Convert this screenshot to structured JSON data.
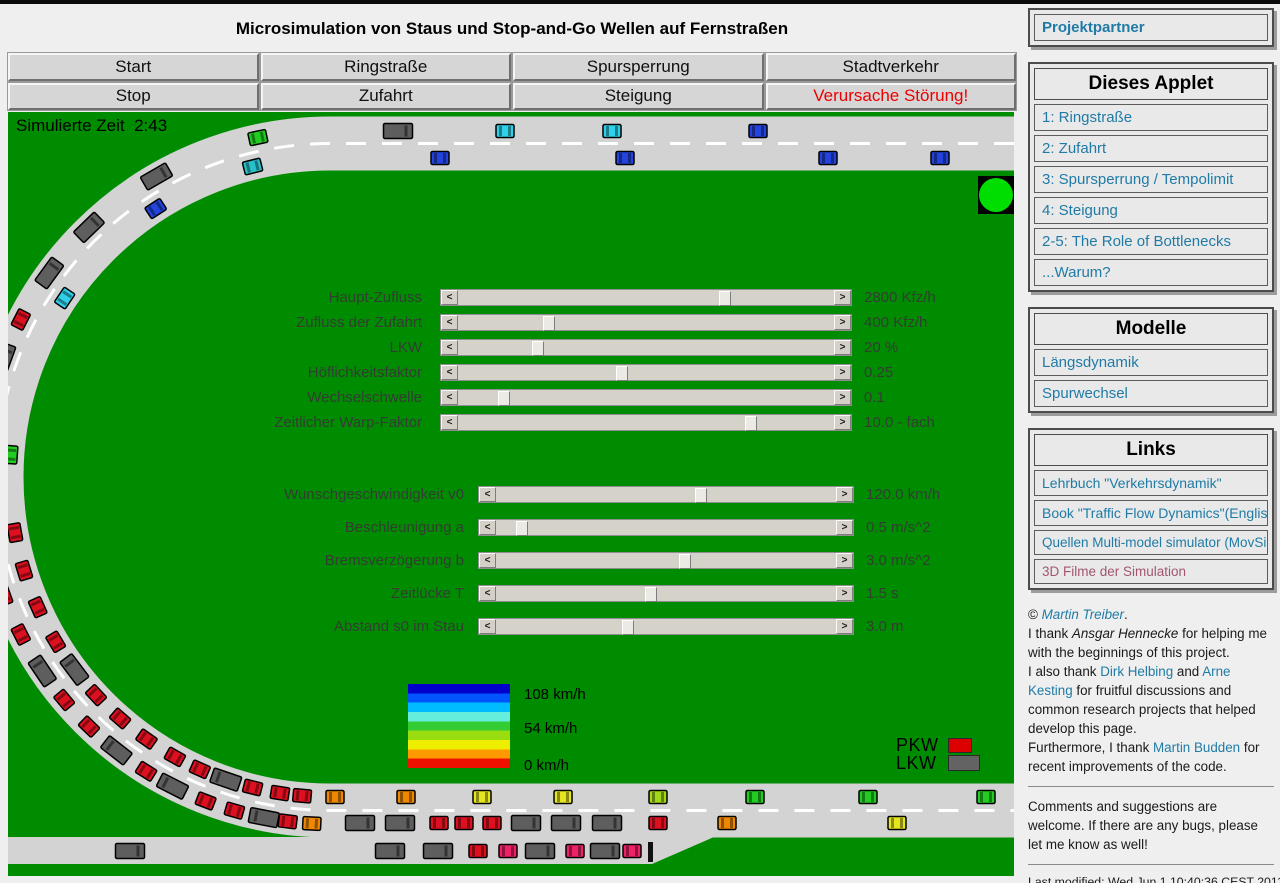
{
  "header": {
    "title": "Microsimulation von Staus und Stop-and-Go Wellen auf Fernstraßen",
    "buttons": [
      {
        "label": "Start"
      },
      {
        "label": "Ringstraße"
      },
      {
        "label": "Spursperrung"
      },
      {
        "label": "Stadtverkehr"
      },
      {
        "label": "Stop"
      },
      {
        "label": "Zufahrt"
      },
      {
        "label": "Steigung"
      },
      {
        "label": "Verursache Störung!",
        "text_color": "#ee0000"
      }
    ]
  },
  "sim": {
    "time_label": "Simulierte Zeit  2:43",
    "background_color": "#008c00",
    "road_color": "#d3d3d3",
    "lane_marking_color": "#ffffff",
    "traffic_light_color": "#00dd00",
    "sliders_group1": [
      {
        "label": "Haupt-Zufluss",
        "value": "2800 Kfz/h",
        "frac": 0.71
      },
      {
        "label": "Zufluss der Zufahrt",
        "value": "400 Kfz/h",
        "frac": 0.23
      },
      {
        "label": "LKW",
        "value": "20 %",
        "frac": 0.2
      },
      {
        "label": "Höflichkeitsfaktor",
        "value": "0.25",
        "frac": 0.43
      },
      {
        "label": "Wechselschwelle",
        "value": "0.1",
        "frac": 0.11
      },
      {
        "label": "Zeitlicher Warp-Faktor",
        "value": "10.0 - fach",
        "frac": 0.78
      }
    ],
    "sliders_group2": [
      {
        "label": "Wunschgeschwindigkeit v0",
        "value": "120.0 km/h",
        "frac": 0.6
      },
      {
        "label": "Beschleunigung a",
        "value": "0.5 m/s^2",
        "frac": 0.06
      },
      {
        "label": "Bremsverzögerung b",
        "value": "3.0 m/s^2",
        "frac": 0.55
      },
      {
        "label": "Zeitlücke T",
        "value": "1.5 s",
        "frac": 0.45
      },
      {
        "label": "Abstand s0 im Stau",
        "value": "3.0 m",
        "frac": 0.38
      }
    ],
    "speed_legend": {
      "labels": [
        "108 km/h",
        "54 km/h",
        "0 km/h"
      ],
      "colors": [
        "#0000cc",
        "#0055ff",
        "#00bbff",
        "#66eedd",
        "#33cc33",
        "#99dd11",
        "#eeee00",
        "#ff9900",
        "#ee1100"
      ]
    },
    "vehicle_legend": [
      {
        "label": "PKW",
        "color": "#dd0000",
        "w": 22,
        "h": 13
      },
      {
        "label": "LKW",
        "color": "#636363",
        "w": 30,
        "h": 14
      }
    ],
    "vehicle_palette": {
      "green": "#22cc22",
      "teal": "#28c0c8",
      "cyan": "#30d0e8",
      "blue": "#2244dd",
      "red": "#dd1020",
      "pink": "#ee2266",
      "orange": "#ee8800",
      "yellow": "#e6e620",
      "ygreen": "#a0d818",
      "truck": "#5e5e5e"
    },
    "vehicles": {
      "top_upper": [
        {
          "x": 390,
          "c": "truck"
        },
        {
          "x": 497,
          "c": "cyan"
        },
        {
          "x": 604,
          "c": "cyan"
        },
        {
          "x": 750,
          "c": "blue"
        }
      ],
      "top_lower": [
        {
          "x": 432,
          "c": "blue"
        },
        {
          "x": 617,
          "c": "blue"
        },
        {
          "x": 820,
          "c": "blue"
        },
        {
          "x": 932,
          "c": "blue"
        }
      ],
      "bottom_upper": [
        {
          "x": 327,
          "c": "orange"
        },
        {
          "x": 398,
          "c": "orange"
        },
        {
          "x": 474,
          "c": "yellow"
        },
        {
          "x": 555,
          "c": "yellow"
        },
        {
          "x": 650,
          "c": "ygreen"
        },
        {
          "x": 747,
          "c": "green"
        },
        {
          "x": 860,
          "c": "green"
        },
        {
          "x": 978,
          "c": "green"
        }
      ],
      "bottom_lower": [
        {
          "x": 352,
          "c": "truck"
        },
        {
          "x": 392,
          "c": "truck"
        },
        {
          "x": 431,
          "c": "red"
        },
        {
          "x": 456,
          "c": "red"
        },
        {
          "x": 484,
          "c": "red"
        },
        {
          "x": 518,
          "c": "truck"
        },
        {
          "x": 558,
          "c": "truck"
        },
        {
          "x": 599,
          "c": "truck"
        },
        {
          "x": 650,
          "c": "red"
        },
        {
          "x": 719,
          "c": "orange"
        },
        {
          "x": 889,
          "c": "yellow"
        }
      ],
      "ramp": [
        {
          "x": 122,
          "c": "truck"
        },
        {
          "x": 382,
          "c": "truck"
        },
        {
          "x": 430,
          "c": "truck"
        },
        {
          "x": 470,
          "c": "red"
        },
        {
          "x": 500,
          "c": "pink"
        },
        {
          "x": 532,
          "c": "truck"
        },
        {
          "x": 567,
          "c": "pink"
        },
        {
          "x": 597,
          "c": "truck"
        },
        {
          "x": 624,
          "c": "pink"
        }
      ],
      "curve": [
        {
          "deg": 12,
          "lane": "O",
          "c": "green"
        },
        {
          "deg": 14,
          "lane": "I",
          "c": "teal"
        },
        {
          "deg": 30,
          "lane": "O",
          "c": "truck"
        },
        {
          "deg": 33,
          "lane": "I",
          "c": "blue"
        },
        {
          "deg": 44,
          "lane": "O",
          "c": "truck"
        },
        {
          "deg": 54,
          "lane": "O",
          "c": "truck"
        },
        {
          "deg": 56,
          "lane": "I",
          "c": "cyan"
        },
        {
          "deg": 63,
          "lane": "O",
          "c": "red"
        },
        {
          "deg": 70,
          "lane": "O",
          "c": "truck"
        },
        {
          "deg": 78,
          "lane": "O",
          "c": "red"
        },
        {
          "deg": 84,
          "lane": "O",
          "c": "red"
        },
        {
          "deg": 86,
          "lane": "I",
          "c": "green"
        },
        {
          "deg": 91,
          "lane": "O",
          "c": "red"
        },
        {
          "deg": 97,
          "lane": "O",
          "c": "red"
        },
        {
          "deg": 100,
          "lane": "I",
          "c": "red"
        },
        {
          "deg": 104,
          "lane": "O",
          "c": "truck"
        },
        {
          "deg": 107,
          "lane": "I",
          "c": "red"
        },
        {
          "deg": 110,
          "lane": "O",
          "c": "red"
        },
        {
          "deg": 114,
          "lane": "I",
          "c": "red"
        },
        {
          "deg": 117,
          "lane": "O",
          "c": "red"
        },
        {
          "deg": 121,
          "lane": "I",
          "c": "red"
        },
        {
          "deg": 124,
          "lane": "O",
          "c": "truck"
        },
        {
          "deg": 127,
          "lane": "I",
          "c": "truck"
        },
        {
          "deg": 130,
          "lane": "O",
          "c": "red"
        },
        {
          "deg": 133,
          "lane": "I",
          "c": "red"
        },
        {
          "deg": 136,
          "lane": "O",
          "c": "red"
        },
        {
          "deg": 139,
          "lane": "I",
          "c": "red"
        },
        {
          "deg": 142,
          "lane": "O",
          "c": "truck"
        },
        {
          "deg": 145,
          "lane": "I",
          "c": "red"
        },
        {
          "deg": 148,
          "lane": "O",
          "c": "red"
        },
        {
          "deg": 151,
          "lane": "I",
          "c": "red"
        },
        {
          "deg": 153,
          "lane": "O",
          "c": "truck"
        },
        {
          "deg": 156,
          "lane": "I",
          "c": "red"
        },
        {
          "deg": 159,
          "lane": "O",
          "c": "red"
        },
        {
          "deg": 161,
          "lane": "I",
          "c": "truck"
        },
        {
          "deg": 164,
          "lane": "O",
          "c": "red"
        },
        {
          "deg": 166,
          "lane": "I",
          "c": "red"
        },
        {
          "deg": 169,
          "lane": "O",
          "c": "truck"
        },
        {
          "deg": 171,
          "lane": "I",
          "c": "red"
        },
        {
          "deg": 173,
          "lane": "O",
          "c": "red"
        },
        {
          "deg": 175,
          "lane": "I",
          "c": "red"
        },
        {
          "deg": 177,
          "lane": "O",
          "c": "orange"
        }
      ]
    }
  },
  "sidebar": {
    "link_color": "#1f7ba6",
    "visited_color": "#a2566f",
    "panels": [
      {
        "links": [
          {
            "label": "Projektpartner",
            "bold": true
          }
        ]
      },
      {
        "title": "Dieses Applet",
        "links": [
          {
            "label": "1: Ringstraße"
          },
          {
            "label": "2: Zufahrt"
          },
          {
            "label": "3: Spursperrung / Tempolimit"
          },
          {
            "label": "4: Steigung"
          },
          {
            "label": "2-5: The Role of Bottlenecks"
          },
          {
            "label": "...Warum?"
          }
        ]
      },
      {
        "title": "Modelle",
        "links": [
          {
            "label": "Längsdynamik"
          },
          {
            "label": "Spurwechsel"
          }
        ]
      },
      {
        "title": "Links",
        "links": [
          {
            "label": "Lehrbuch \"Verkehrsdynamik\"",
            "fs": 14
          },
          {
            "label": "Book \"Traffic Flow Dynamics\"(English)",
            "fs": 14
          },
          {
            "label": "Quellen Multi-model simulator (MovSim)",
            "fs": 13.5
          },
          {
            "label": "3D Filme der Simulation",
            "fs": 13.5,
            "visited": true
          }
        ]
      }
    ],
    "credits": [
      {
        "t": "© ",
        "s": "p"
      },
      {
        "t": "Martin Treiber",
        "s": "il"
      },
      {
        "t": ".",
        "s": "p"
      },
      {
        "br": true
      },
      {
        "t": "I thank ",
        "s": "p"
      },
      {
        "t": "Ansgar Hennecke",
        "s": "i"
      },
      {
        "t": " for helping me with the beginnings of this project.",
        "s": "p"
      },
      {
        "br": true
      },
      {
        "t": "I also thank ",
        "s": "p"
      },
      {
        "t": "Dirk Helbing",
        "s": "l"
      },
      {
        "t": " and ",
        "s": "p"
      },
      {
        "t": "Arne Kesting",
        "s": "l"
      },
      {
        "t": " for fruitful discussions and common research projects that helped develop this page.",
        "s": "p"
      },
      {
        "br": true
      },
      {
        "t": "Furthermore, I thank ",
        "s": "p"
      },
      {
        "t": "Martin Budden",
        "s": "l"
      },
      {
        "t": " for recent improvements of the code.",
        "s": "p"
      }
    ],
    "comments_note": "Comments and suggestions are welcome. If there are any bugs, please let me know as well!",
    "last_modified": "Last modified: Wed Jun 1 10:40:36 CEST 2011"
  }
}
